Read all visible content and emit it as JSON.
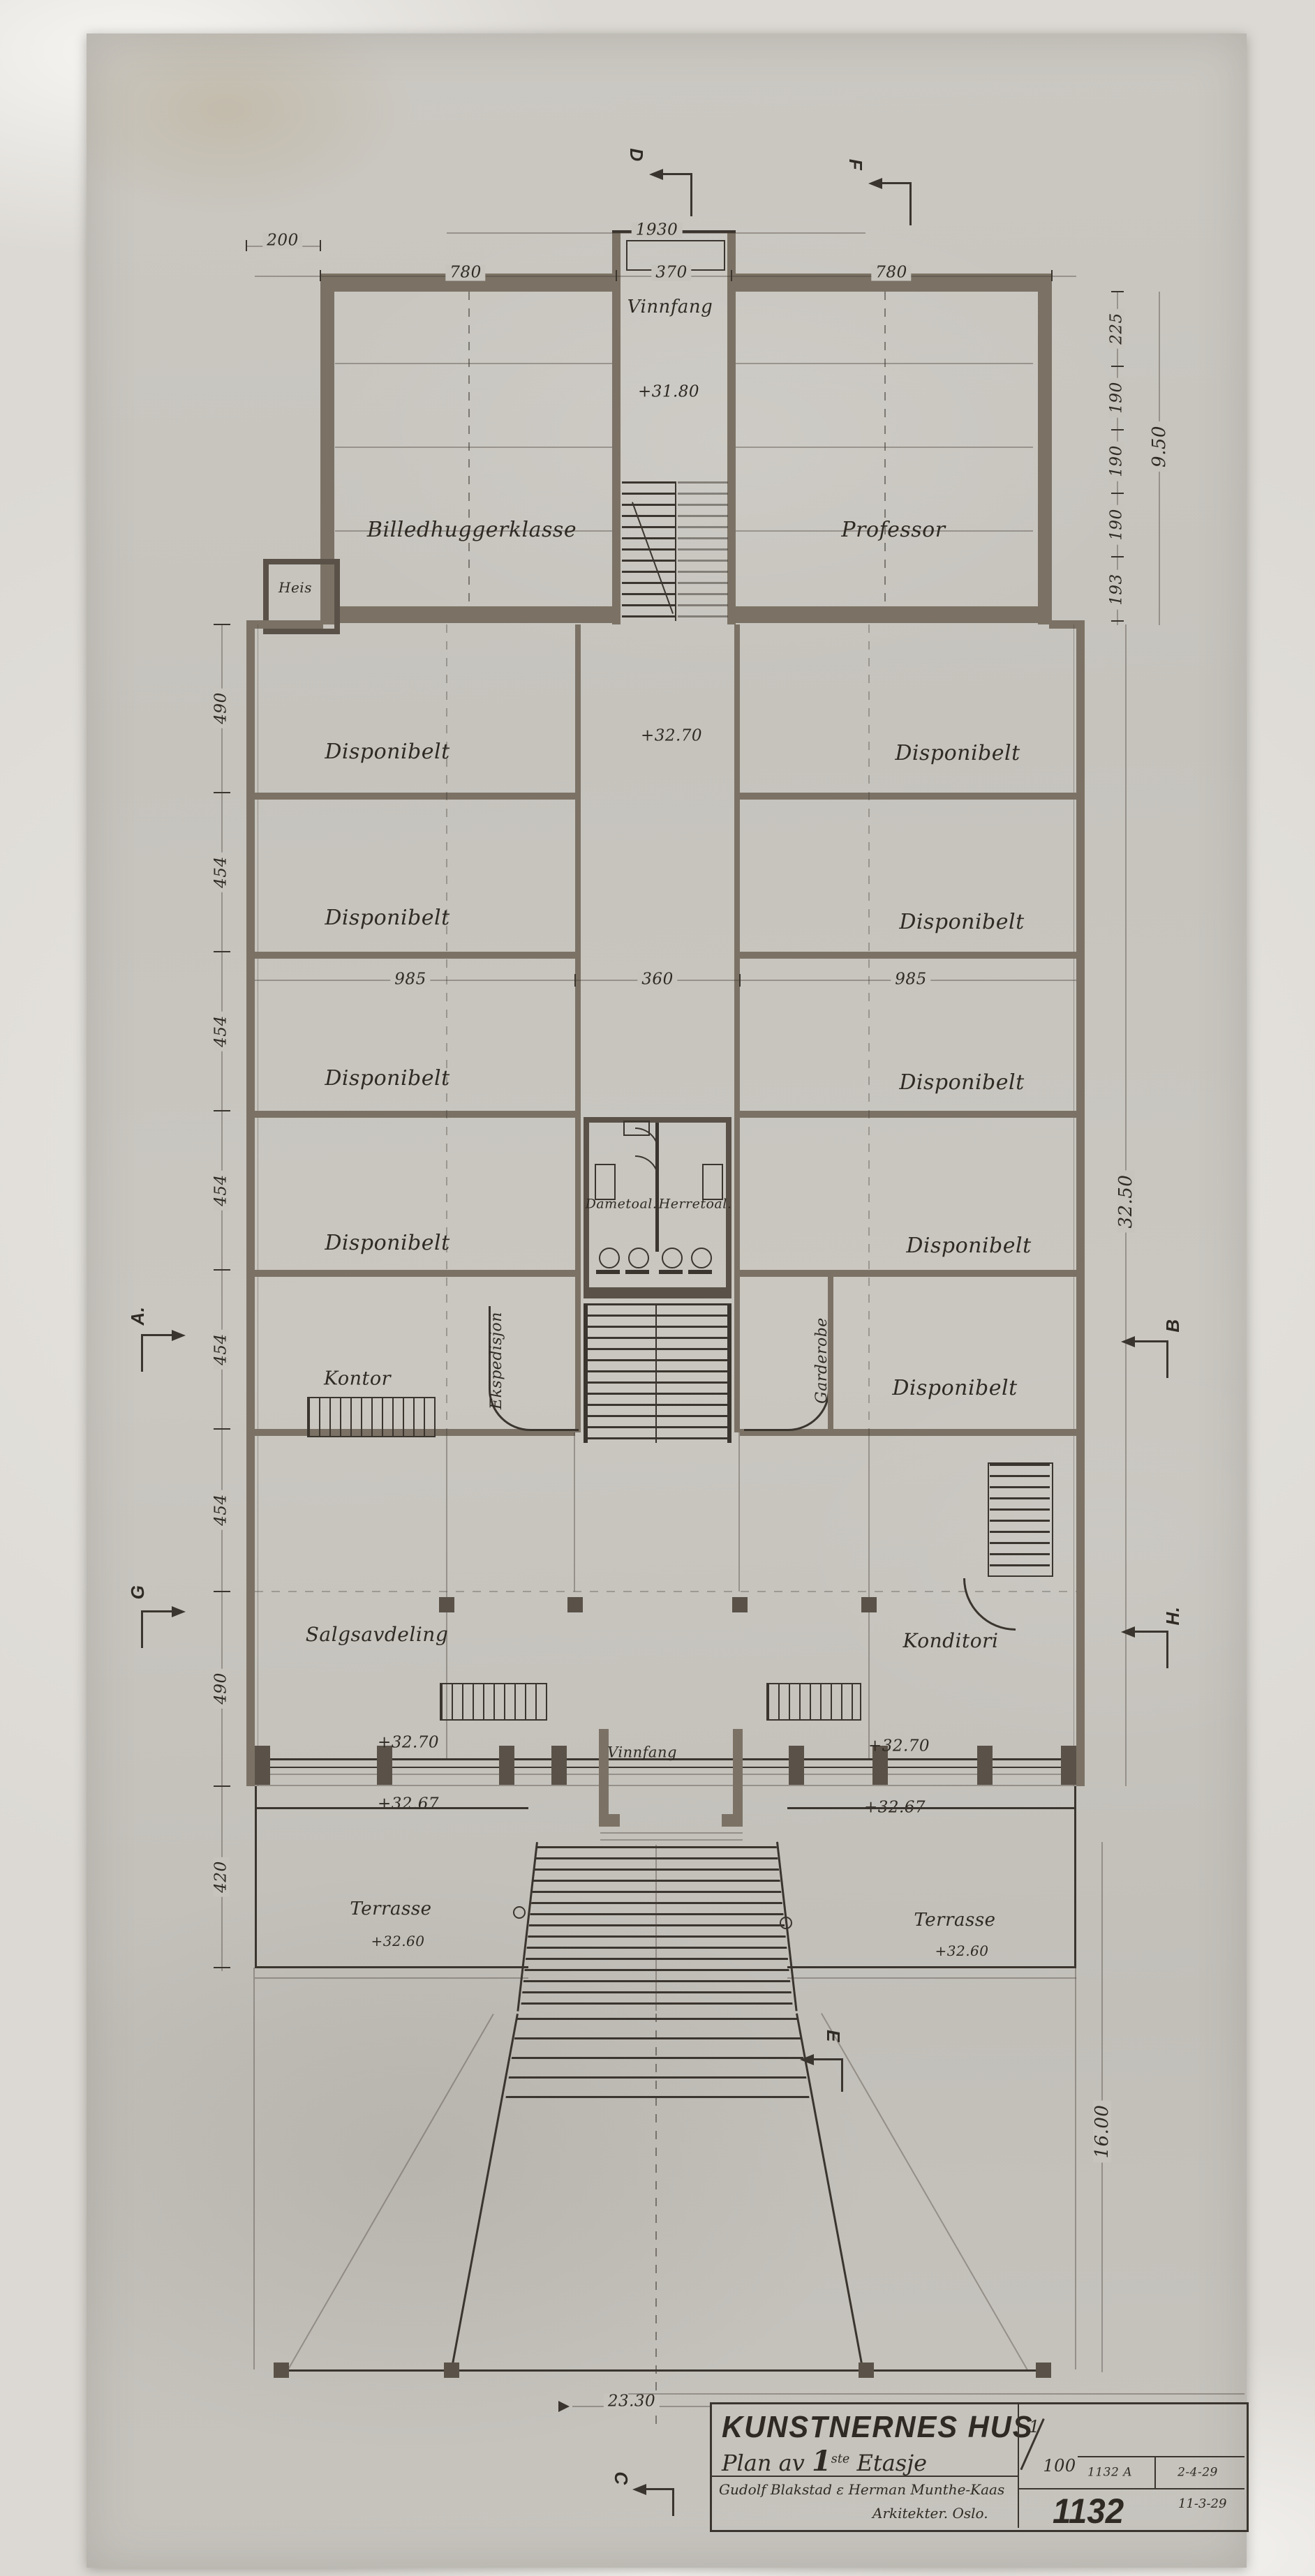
{
  "colors": {
    "backdrop": "#e8e6e2",
    "paper": "#c8c5bf",
    "paper_shade": "#b9b6b0",
    "ink": "#3a352e",
    "ink_soft": "#6e675d",
    "wall_fill": "#7b7265",
    "wall_dark": "#5a5248",
    "label": "#2f2a24"
  },
  "title_block": {
    "project_title": "KUNSTNERNES HUS",
    "plan_prefix": "Plan av",
    "plan_floor": "1",
    "plan_floor_sup": "ste",
    "plan_suffix": "Etasje",
    "architects_line1": "Gudolf Blakstad ε Herman Munthe-Kaas",
    "architects_line2": "Arkitekter. Oslo.",
    "scale_numerator": "1",
    "scale_denominator": "100",
    "revision_number": "1132 A",
    "revision_date": "2-4-29",
    "drawing_number": "1132",
    "drawing_date": "11-3-29"
  },
  "rooms": {
    "vinnfang_upper": "Vinnfang",
    "billedhuggerklasse": "Billedhuggerklasse",
    "professor": "Professor",
    "heis": "Heis",
    "disponibelt": "Disponibelt",
    "kontor": "Kontor",
    "ekspedisjon": "Ekspedisjon",
    "garderobe": "Garderobe",
    "dametoal": "Dametoal.",
    "herretoal": "Herretoal.",
    "salgsavdeling": "Salgsavdeling",
    "konditori": "Konditori",
    "vinnfang_lower": "Vinnfang",
    "terrasse": "Terrasse"
  },
  "elevations": {
    "upper_vestibule": "+31.80",
    "corridor": "+32.70",
    "hall_left": "+32.70",
    "hall_left_outer": "+32.67",
    "hall_right": "+32.70",
    "hall_right_outer": "+32.67",
    "terrace_left": "+32.60",
    "terrace_right": "+32.60"
  },
  "dimensions": {
    "top_offset": "200",
    "top_overall": "1930",
    "top_left_wing": "780",
    "top_center": "370",
    "top_right_wing": "780",
    "right_upper": [
      "225",
      "190",
      "190",
      "190",
      "193"
    ],
    "right_upper_total": "9.50",
    "left_chain": [
      "490",
      "454",
      "454",
      "454",
      "454",
      "454",
      "490",
      "420"
    ],
    "middle_left": "985",
    "middle_center": "360",
    "middle_right": "985",
    "right_main_total": "32.50",
    "right_lower_total": "16.00",
    "bottom": "23.30"
  },
  "section_markers": {
    "d": "D",
    "f": "F",
    "a": "A.",
    "b": "B",
    "g": "G",
    "h": "H.",
    "e": "E",
    "c": "C"
  }
}
